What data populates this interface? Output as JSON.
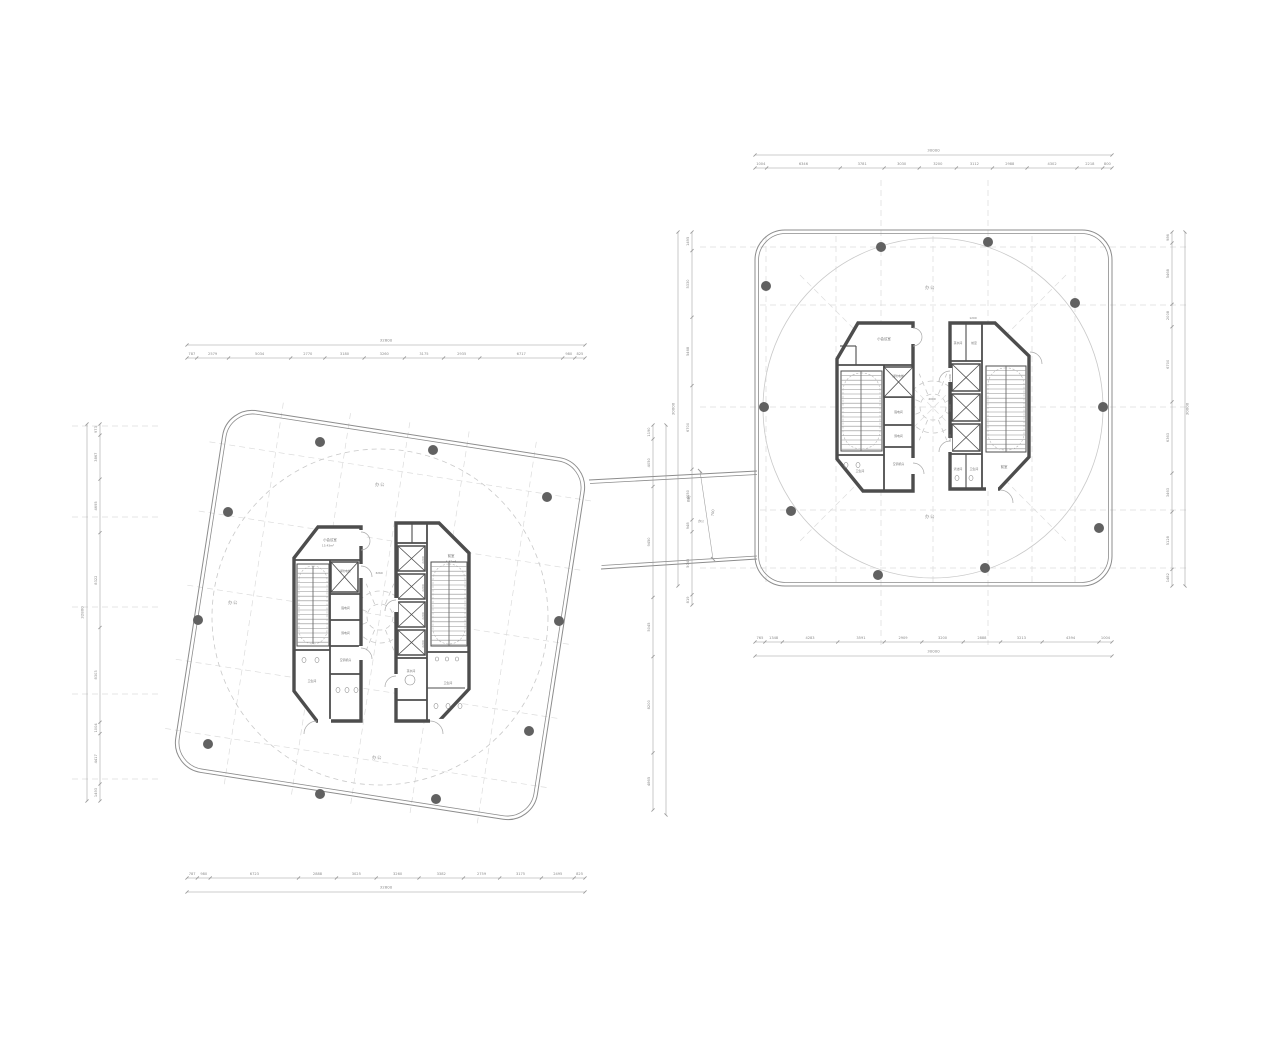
{
  "meta": {
    "background": "#ffffff",
    "outline_color": "#8c8c8c",
    "wall_color": "#4d4d4d",
    "column_color": "#616161",
    "dim_color": "#9b9b9b",
    "grid_color": "#dcdcdc"
  },
  "left_plan": {
    "total_top": "32800",
    "total_bottom": "32800",
    "total_left": "32800",
    "dims_top": [
      "787",
      "2579",
      "5034",
      "2770",
      "3180",
      "3260",
      "3175",
      "2935",
      "6717",
      "980",
      "825"
    ],
    "dims_bottom": [
      "787",
      "980",
      "6723",
      "2888",
      "3025",
      "3260",
      "3382",
      "2759",
      "3175",
      "2495",
      "825"
    ],
    "dims_left": [
      "973",
      "3867",
      "4695",
      "8322",
      "8303",
      "1004",
      "4417",
      "1493"
    ],
    "dims_right": [
      "1190",
      "4050",
      "9450",
      "5045",
      "8200",
      "4865"
    ],
    "rooms": {
      "meeting": "小会议室",
      "meeting_area": "15.43m²",
      "fire_elevator": "消防电梯",
      "power": "强电间",
      "telecom": "弱电间",
      "ac": "空调机房",
      "toilet": "卫生间",
      "vestibule": "前室",
      "vestibule_area": "6.82m²",
      "pantry": "茶水间",
      "lobby_dim": "3260",
      "shaft_dim": "2200",
      "office": "办公"
    }
  },
  "right_plan": {
    "total_top": "30000",
    "total_bottom": "30000",
    "total_right": "30000",
    "total_left": "30000",
    "dims_top": [
      "1004",
      "6346",
      "3781",
      "3030",
      "3200",
      "3112",
      "2988",
      "4302",
      "2218",
      "800"
    ],
    "dims_bottom": [
      "765",
      "1348",
      "4283",
      "3591",
      "2909",
      "3200",
      "2888",
      "3213",
      "4394",
      "1004"
    ],
    "dims_right": [
      "986",
      "5468",
      "2008",
      "6700",
      "6363",
      "3463",
      "5128",
      "1482"
    ],
    "dims_left": [
      "1495",
      "5330",
      "5468",
      "6700",
      "4050",
      "948",
      "5045",
      "819"
    ],
    "rooms": {
      "meeting": "小会议室",
      "fire_elevator": "消防电梯",
      "power": "强电间",
      "telecom": "弱电间",
      "ac": "空调机房",
      "toilet": "卫生间",
      "cleaning": "清洁间",
      "vestibule": "前室",
      "pantry": "茶水间",
      "lobby_dim": "2000",
      "top_dim": "1200",
      "shaft_dim": "2200",
      "office": "办公"
    }
  },
  "bridge": {
    "dim_a": "700",
    "dim_b": "898",
    "office": "办公"
  }
}
